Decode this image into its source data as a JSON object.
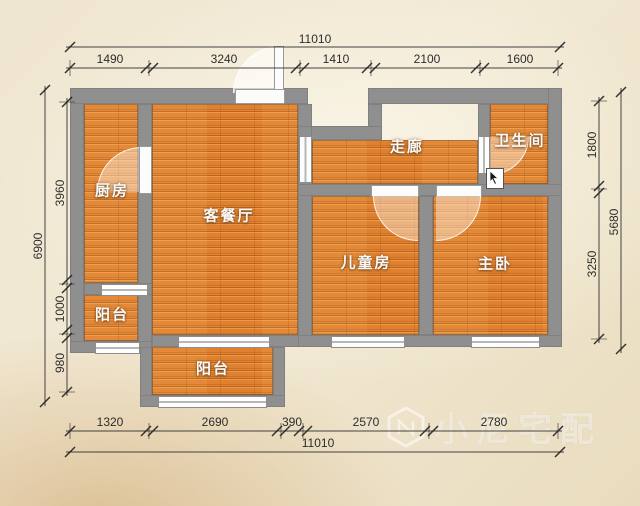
{
  "watermark": {
    "text": "小尼宅配",
    "logo": "cube-logo"
  },
  "rooms": {
    "kitchen": {
      "label": "厨房"
    },
    "living_dining": {
      "label": "客餐厅"
    },
    "corridor": {
      "label": "走廊"
    },
    "bathroom": {
      "label": "卫生间"
    },
    "kids_room": {
      "label": "儿童房"
    },
    "master_bedroom": {
      "label": "主卧"
    },
    "balcony_left": {
      "label": "阳台"
    },
    "balcony_bottom": {
      "label": "阳台"
    }
  },
  "dimensions": {
    "top": {
      "total": "11010",
      "segments": [
        "1490",
        "3240",
        "1410",
        "2100",
        "1600"
      ]
    },
    "bottom": {
      "total": "11010",
      "segments": [
        "1320",
        "2690",
        "390",
        "2570",
        "2780"
      ]
    },
    "left": {
      "total": "6900",
      "segments": [
        "3960",
        "1000",
        "980"
      ]
    },
    "right": {
      "total": "5680",
      "segments": [
        "1800",
        "3250"
      ]
    }
  },
  "colors": {
    "floor": "#e0812f",
    "wall": "#8f8f8f",
    "background": "#efe6d0",
    "dimension_text": "#2d2d2d",
    "label_text": "#fafafa"
  }
}
